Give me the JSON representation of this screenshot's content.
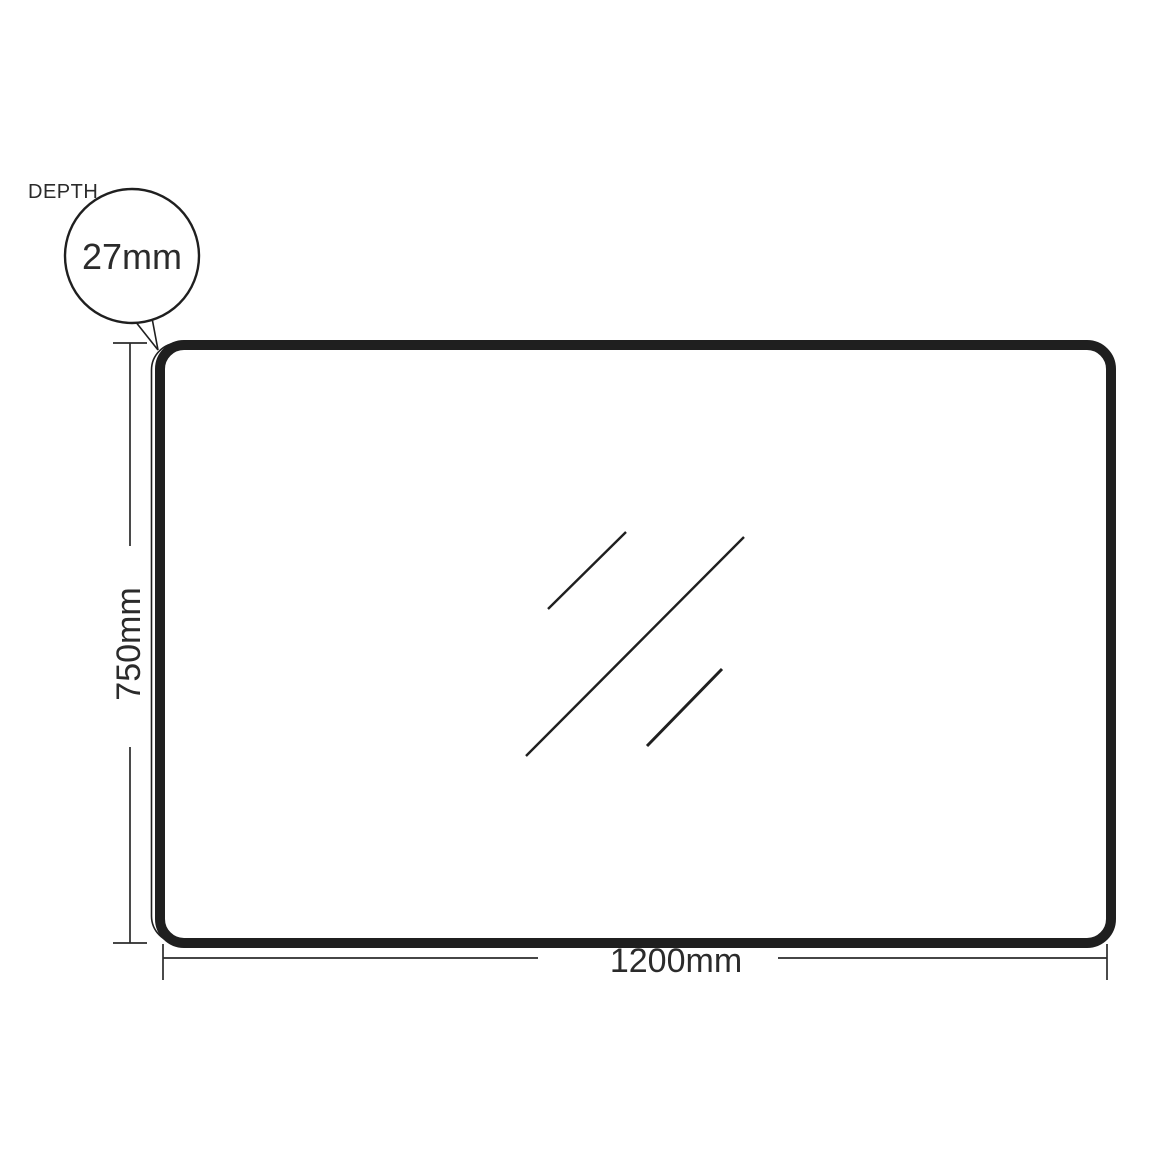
{
  "drawing": {
    "depth_label": "DEPTH",
    "depth_value": "27mm",
    "height_dim": "750mm",
    "width_dim": "1200mm",
    "colors": {
      "outline": "#1f1f1f",
      "dim": "#2b2b2b",
      "background": "#ffffff"
    }
  }
}
